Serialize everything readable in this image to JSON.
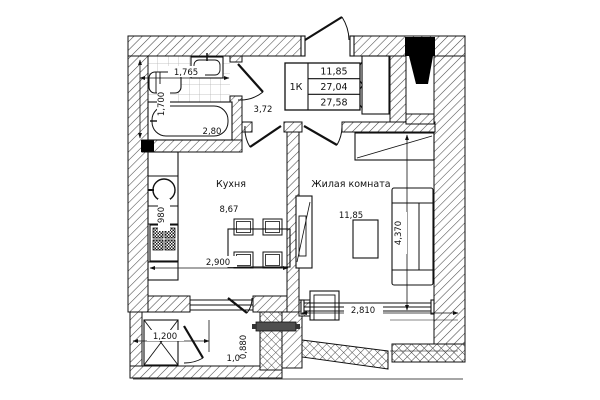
{
  "legend": {
    "type": "1К",
    "living_area": "11,85",
    "total_area": "27,04",
    "total_area_with_balcony": "27,58"
  },
  "rooms": {
    "kitchen": {
      "name": "Кухня",
      "area": "8,67",
      "width": "2,900",
      "counter_depth": "980"
    },
    "living_room": {
      "name": "Жилая комната",
      "area": "11,85",
      "width": "2,810",
      "depth": "4,370"
    },
    "hallway": {
      "area": "3,72"
    },
    "bathroom": {
      "area": "2,80",
      "width": "1,765",
      "depth": "1,700"
    },
    "balcony": {
      "width": "1,200",
      "depth": "0,880",
      "door_width": "1,07"
    }
  },
  "colors": {
    "line": "#111111",
    "hatch": "#4a4a4a",
    "tile_grid": "#b5b5b5",
    "shaft_fill": "#000000",
    "radiator_fill": "#4f4f4f",
    "background": "#ffffff"
  }
}
